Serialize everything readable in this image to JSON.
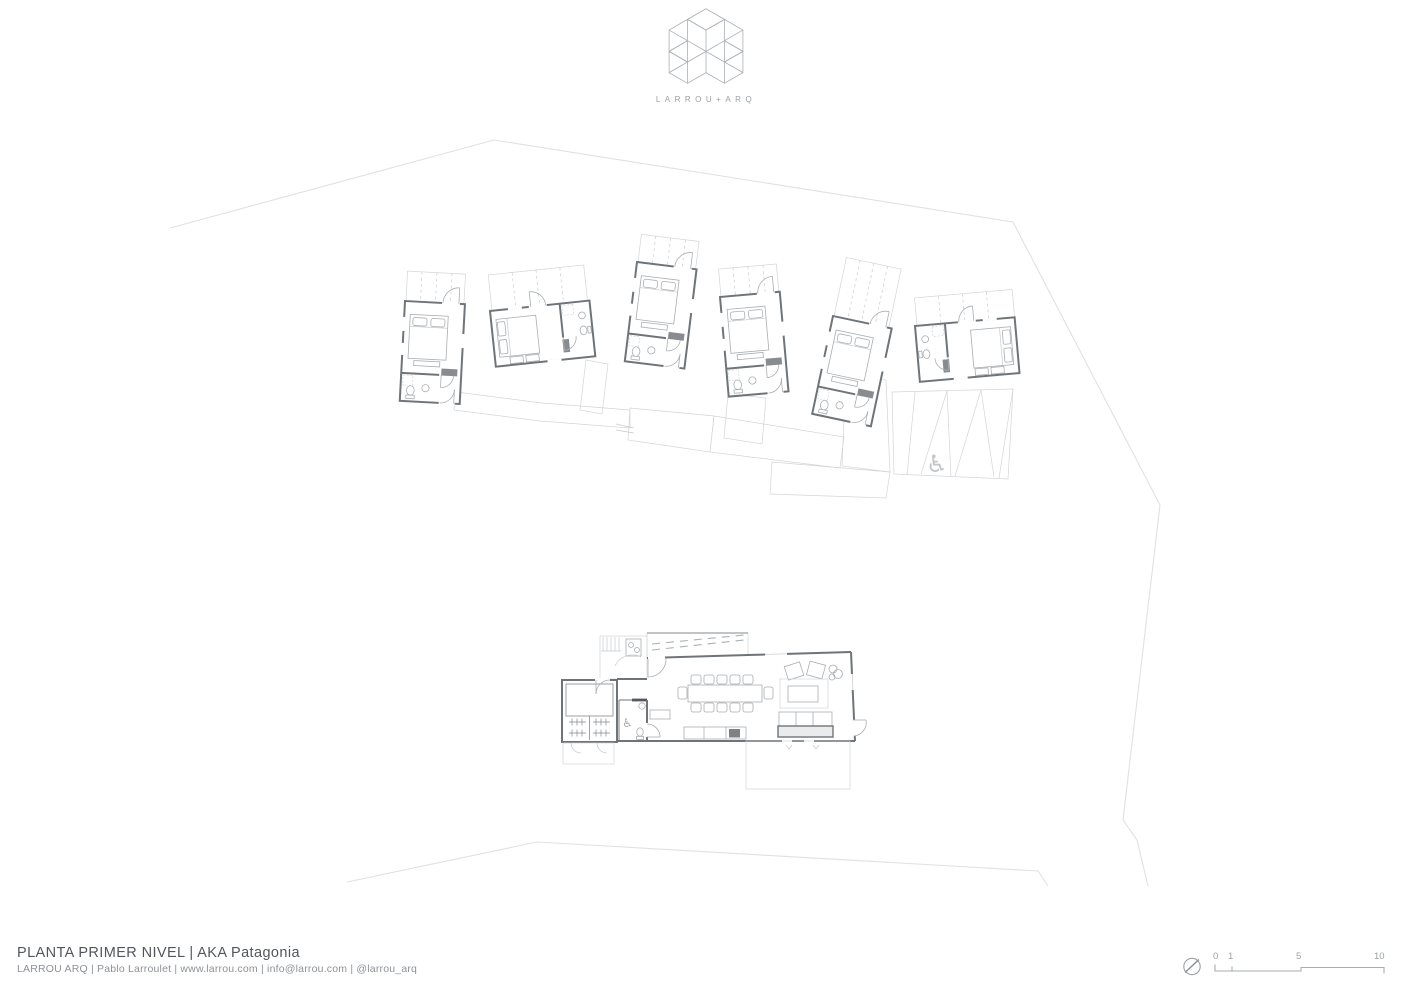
{
  "sheet": {
    "kind": "architectural floor plan"
  },
  "logo": {
    "text": "LARROU+ARQ"
  },
  "title_block": {
    "title": "PLANTA PRIMER NIVEL | AKA Patagonia",
    "credits": "LARROU ARQ | Pablo Larroulet | www.larrou.com | info@larrou.com | @larrou_arq"
  },
  "scale_bar": {
    "labels": [
      "0",
      "1",
      "5",
      "10"
    ]
  },
  "icons": {
    "wheelchair_glyph": "♿",
    "north_indicator": "compass-needle-icon",
    "logo_mark": "isometric-cube-cross"
  },
  "colors": {
    "background": "#ffffff",
    "walls": "#6f7478",
    "light_lines": "#a9aeb2",
    "hatch": "#dcdfe1",
    "site_boundary": "#dfe1e3",
    "title_text": "#53575c",
    "credit_text": "#8d9297"
  },
  "plan": {
    "cabin_count": 6,
    "depicted": [
      "guest cabins with hatched porches",
      "boardwalk connecting cabins",
      "parking area with accessible stall",
      "common building with dining table, lounge, kitchen, bathroom, gear storage and decks",
      "site boundary lines"
    ]
  }
}
